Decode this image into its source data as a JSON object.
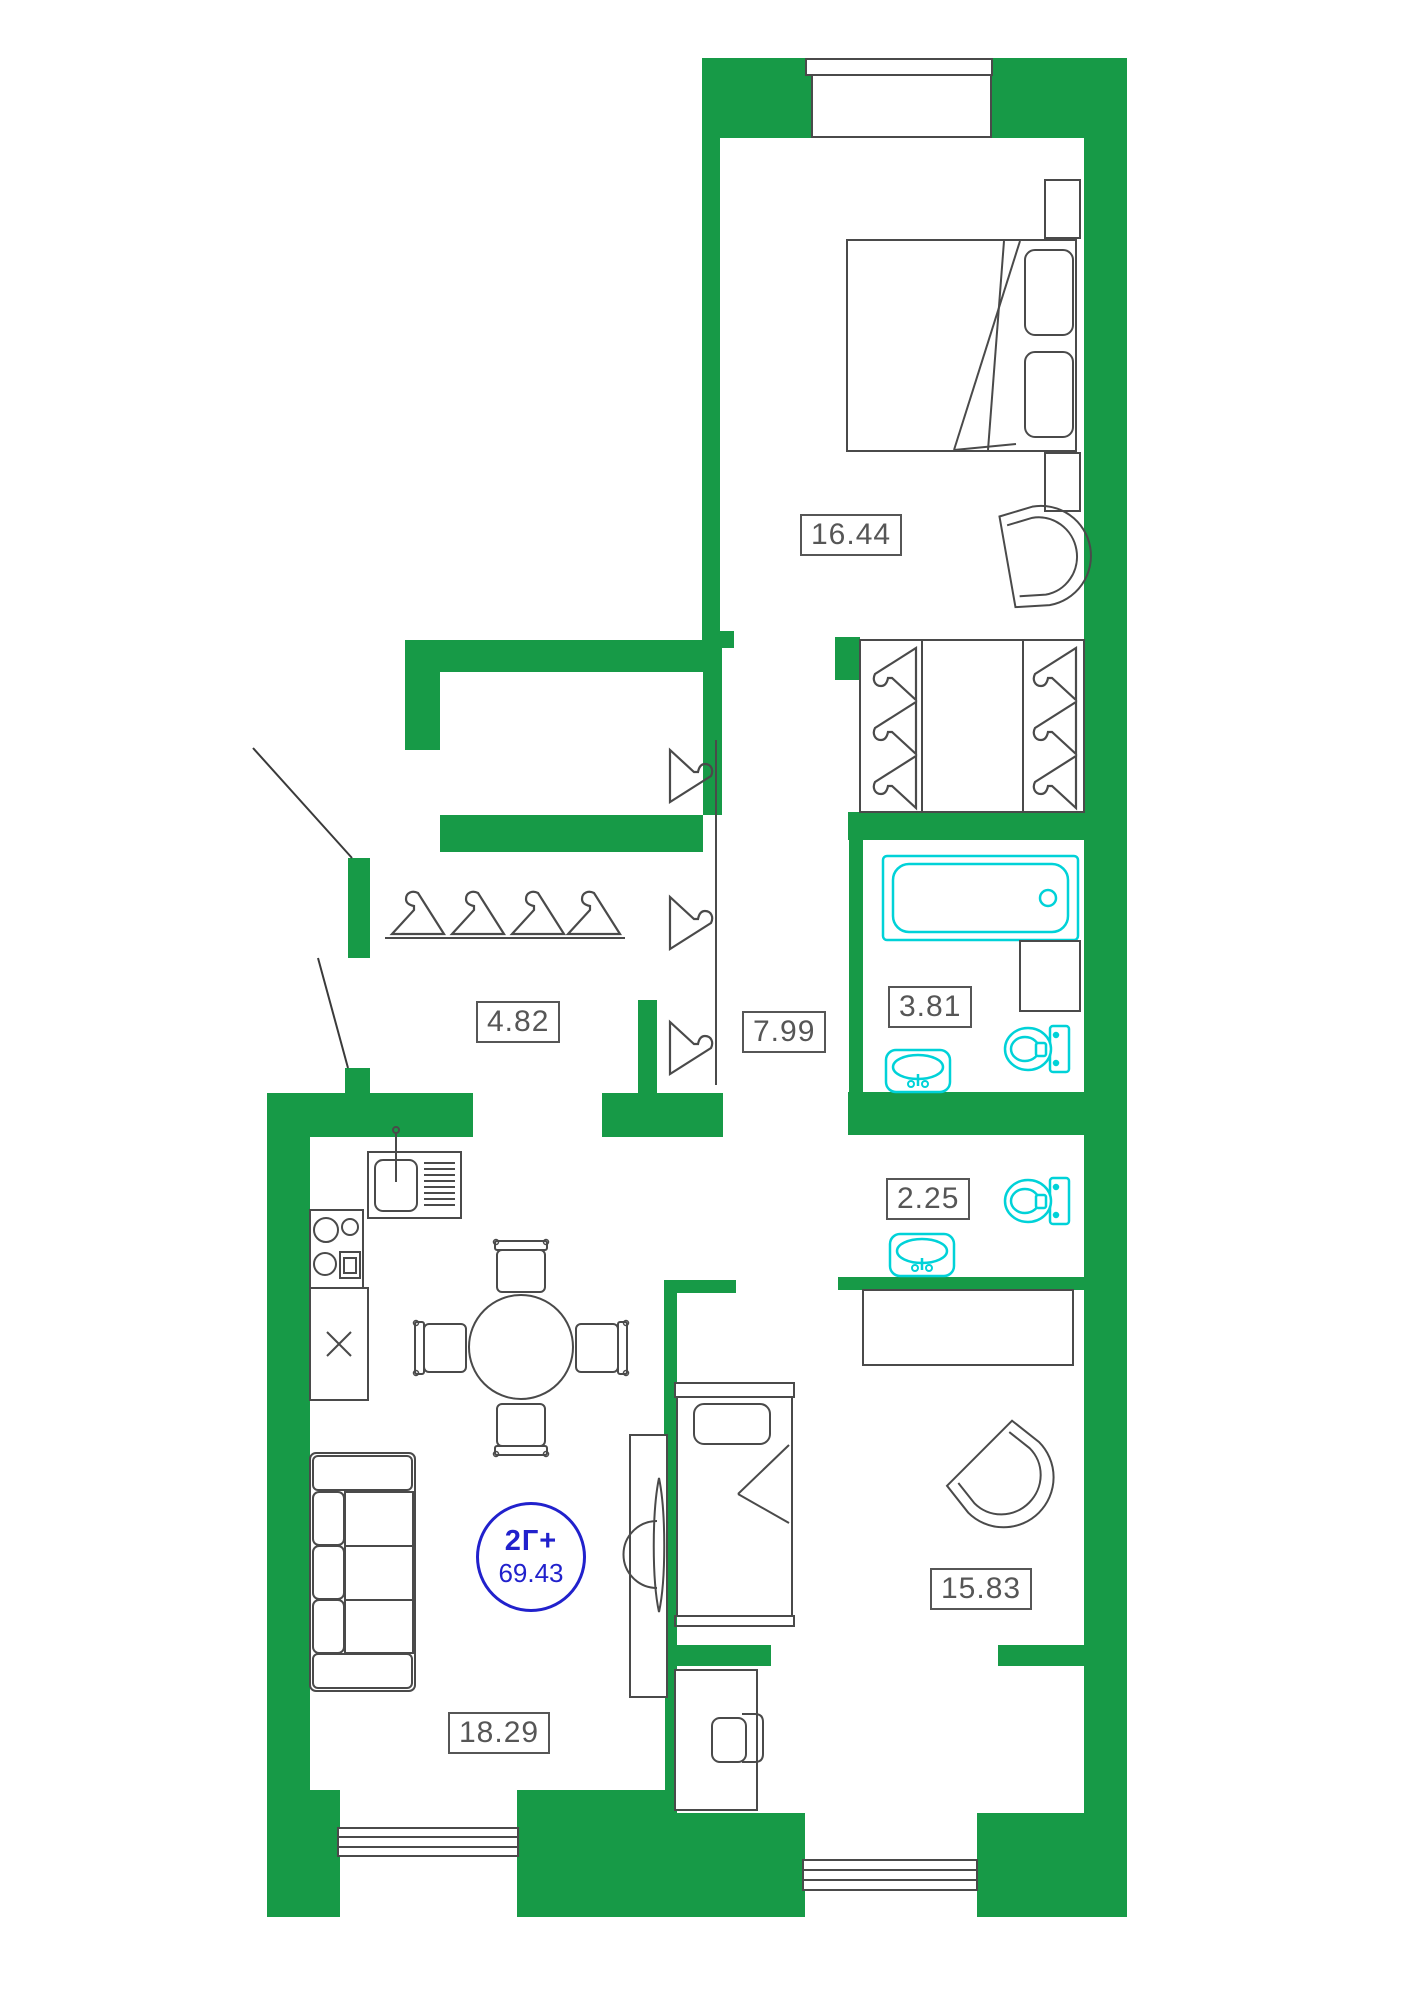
{
  "unit": {
    "type_label": "2Г+",
    "area": "69.43"
  },
  "rooms": [
    {
      "name": "bedroom-top",
      "area_label": "16.44"
    },
    {
      "name": "entry-hall",
      "area_label": "4.82"
    },
    {
      "name": "corridor",
      "area_label": "7.99"
    },
    {
      "name": "bathroom",
      "area_label": "3.81"
    },
    {
      "name": "wc",
      "area_label": "2.25"
    },
    {
      "name": "bedroom-right",
      "area_label": "15.83"
    },
    {
      "name": "living-kitchen",
      "area_label": "18.29"
    }
  ],
  "colors": {
    "wall_green": "#179A47",
    "fixture_cyan": "#00D2D8",
    "line_gray": "#4A4A4A",
    "label_gray": "#565656",
    "badge_blue": "#2121CC",
    "background": "#FFFFFF"
  },
  "icons": {
    "hanger": "hanger-icon",
    "bathtub": "bathtub-icon",
    "toilet": "toilet-icon",
    "sink": "sink-icon",
    "armchair": "armchair-icon",
    "sofa": "sofa-icon",
    "double-bed": "double-bed-icon",
    "single-bed": "single-bed-icon",
    "dining-table": "dining-table-icon",
    "chair": "chair-icon",
    "tv": "tv-icon",
    "stove": "stove-icon",
    "kitchen-sink": "kitchen-sink-icon",
    "desk": "desk-icon",
    "wardrobe": "wardrobe-icon",
    "door-swing": "door-swing-icon",
    "window": "window-icon"
  }
}
